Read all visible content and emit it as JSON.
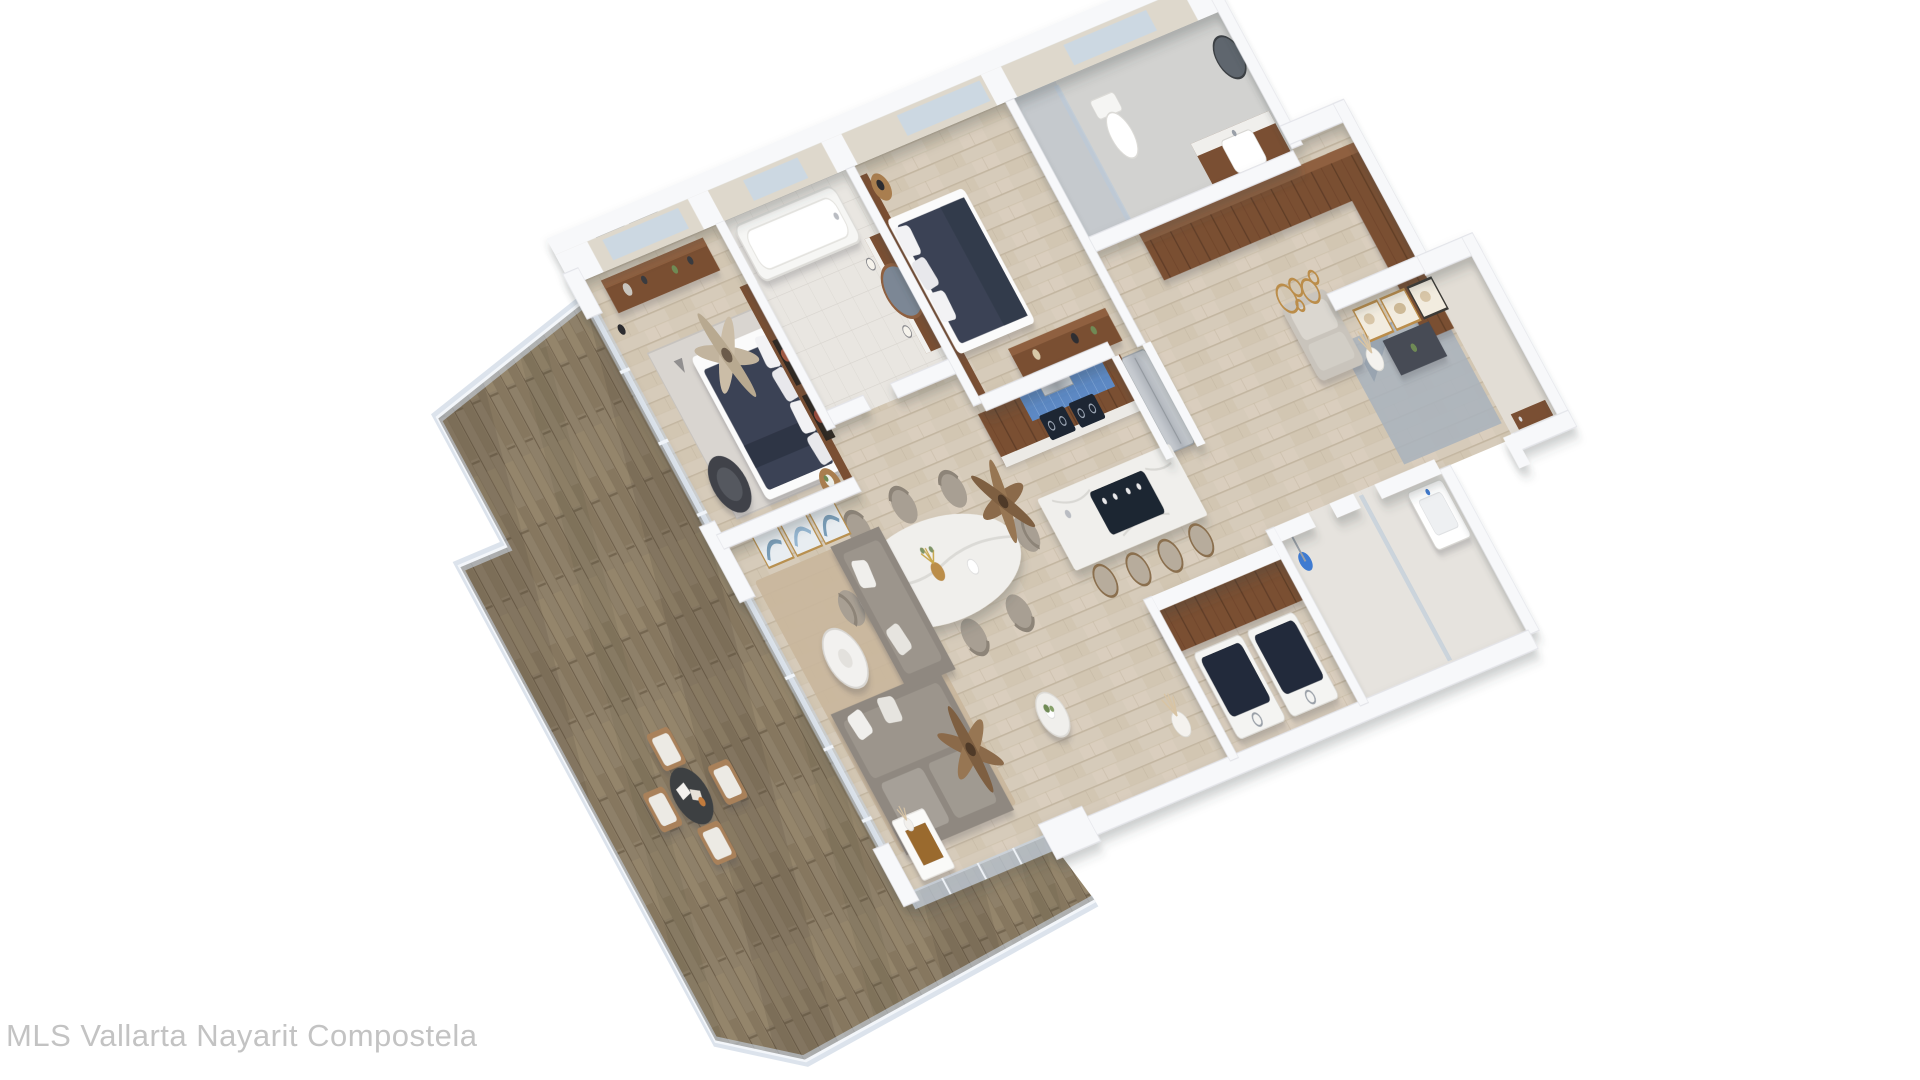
{
  "watermark": {
    "text": "MLS Vallarta Nayarit Compostela"
  },
  "palette": {
    "bg": "#ffffff",
    "watermark": "#c3c3c3",
    "wall": "#f7f8fa",
    "wall_edge": "#e3e4e9",
    "wall_face": "#ded8cc",
    "floor_wood": "#d6cbba",
    "deck_wood": "#8e8069",
    "walnut": "#7a4f33",
    "walnut_dark": "#5f3c26",
    "navy_bed": "#3b4254",
    "sofa_gray": "#8f8880",
    "beige_chair": "#a89f93",
    "marble": "#f0efec",
    "glass": "#c6d3e2",
    "backsplash_blue": "#5d89c4",
    "appliance_dark": "#1d2633",
    "steel": "#b9bcc2",
    "gold": "#bb8d4a",
    "rug_tan": "#c9b69c",
    "rug_gray": "#d9d5d0",
    "rug_blue": "#aab3bc",
    "plant_green": "#6f8a55"
  },
  "scene": {
    "type": "3d-rendered-floor-plan",
    "view": "isometric top-down",
    "rooms": [
      {
        "name": "master-bedroom",
        "furniture": [
          "double bed with navy duvet",
          "walnut headboard wall",
          "two red abstract artworks",
          "dresser with decor",
          "two black-and-white framed prints",
          "dark armchair",
          "side table with plant",
          "patterned rug",
          "ceiling fan"
        ]
      },
      {
        "name": "master-bathroom",
        "furniture": [
          "bathtub",
          "walnut vanity",
          "round mirror",
          "pendant lights"
        ]
      },
      {
        "name": "bedroom-2",
        "furniture": [
          "double bed with navy duvet",
          "round nightstand with black lamp",
          "walnut media console"
        ]
      },
      {
        "name": "bathroom-2",
        "furniture": [
          "glass shower",
          "toilet",
          "walnut vanity with sink",
          "round dark mirror"
        ]
      },
      {
        "name": "walk-in-closet",
        "furniture": [
          "L-shaped walnut wardrobe"
        ]
      },
      {
        "name": "foyer",
        "furniture": [
          "three gold-framed abstract artworks",
          "dark console",
          "pampas vase",
          "beige sofa",
          "gold ring wall art",
          "blue-gray rug",
          "walnut entry door"
        ]
      },
      {
        "name": "kitchen",
        "furniture": [
          "walnut cabinets",
          "blue tile backsplash",
          "range hood",
          "cooktop",
          "stainless fridge",
          "marble island with black cooktop",
          "four bar stools"
        ]
      },
      {
        "name": "dining-area",
        "furniture": [
          "oval marble table",
          "eight beige chairs",
          "gold vase centerpiece",
          "ceiling fan"
        ]
      },
      {
        "name": "living-room",
        "furniture": [
          "gray sectional sofa",
          "white pillows",
          "round white coffee table",
          "marble side table with plant",
          "white console table",
          "three teal framed artworks",
          "tan rug",
          "ceiling fan",
          "pampas vase"
        ]
      },
      {
        "name": "laundry-room",
        "furniture": [
          "washer",
          "dryer",
          "walnut counter"
        ]
      },
      {
        "name": "shower-room",
        "furniture": [
          "shower head",
          "glass partition"
        ]
      },
      {
        "name": "powder-room",
        "furniture": [
          "wall-hung basin"
        ]
      },
      {
        "name": "terrace",
        "furniture": [
          "weathered wood deck",
          "glass balustrade",
          "round outdoor table",
          "four cushioned wood chairs"
        ]
      }
    ]
  }
}
